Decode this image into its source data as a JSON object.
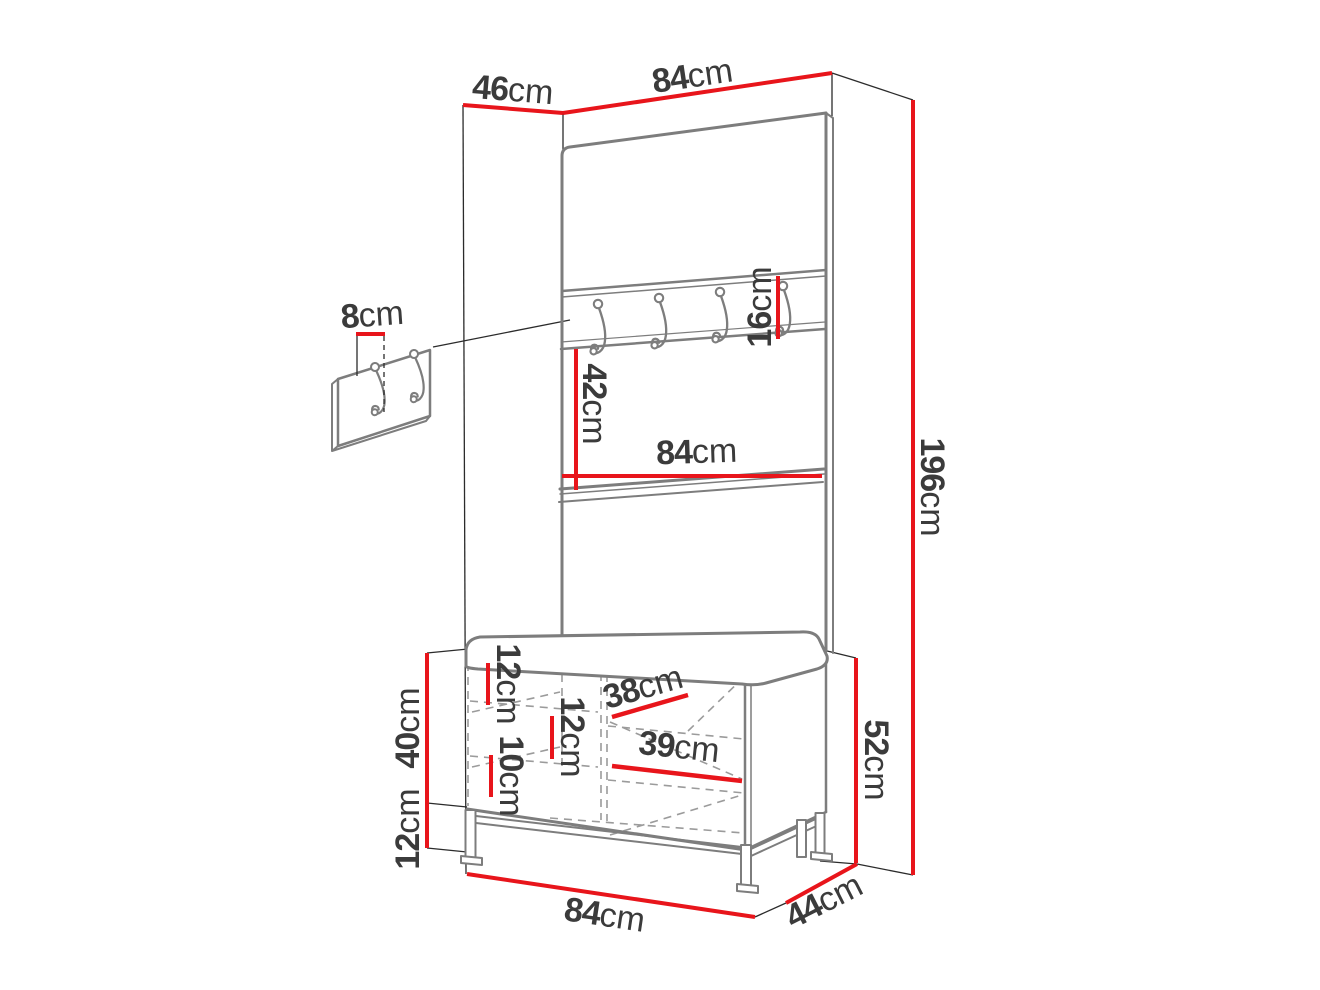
{
  "diagram_title": "hallway furniture set dimension diagram",
  "unit_default": "cm",
  "colors": {
    "dim": "#e8151b",
    "outline": "#7d7d7d",
    "wire": "#2b2b2b",
    "dash": "#9b9b9b",
    "text": "#3b3b3b",
    "bg": "#ffffff"
  },
  "dims": {
    "top_depth": {
      "value": "46",
      "unit": "cm"
    },
    "top_width": {
      "value": "84",
      "unit": "cm"
    },
    "total_height": {
      "value": "196",
      "unit": "cm"
    },
    "hook_rail_height": {
      "value": "16",
      "unit": "cm"
    },
    "mirror_section_height": {
      "value": "42",
      "unit": "cm"
    },
    "shelf_width": {
      "value": "84",
      "unit": "cm"
    },
    "wall_hook_spacing": {
      "value": "8",
      "unit": "cm"
    },
    "inner_gap_top": {
      "value": "12",
      "unit": "cm"
    },
    "inner_gap_middle": {
      "value": "12",
      "unit": "cm"
    },
    "inner_gap_bottom": {
      "value": "10",
      "unit": "cm"
    },
    "inner_width_upper": {
      "value": "38",
      "unit": "cm"
    },
    "inner_width_lower": {
      "value": "39",
      "unit": "cm"
    },
    "bench_body_height": {
      "value": "40",
      "unit": "cm"
    },
    "leg_height": {
      "value": "12",
      "unit": "cm"
    },
    "bench_total_height": {
      "value": "52",
      "unit": "cm"
    },
    "bench_width": {
      "value": "84",
      "unit": "cm"
    },
    "bench_depth": {
      "value": "44",
      "unit": "cm"
    }
  }
}
